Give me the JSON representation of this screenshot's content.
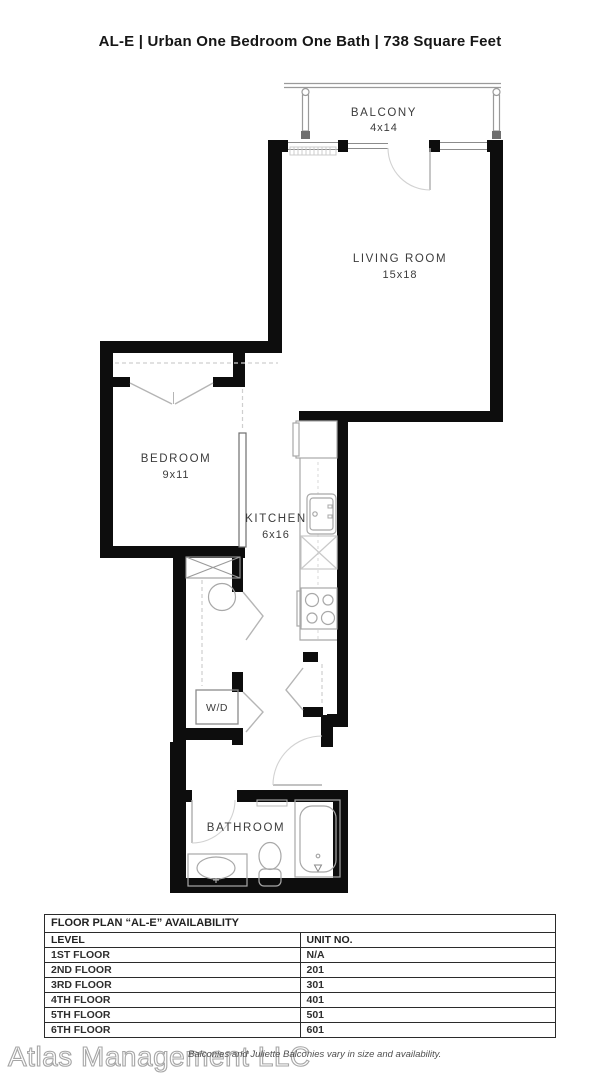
{
  "page_title": "AL-E | Urban One Bedroom One Bath | 738 Square Feet",
  "plan": {
    "balcony": {
      "name": "BALCONY",
      "dims": "4x14"
    },
    "living_room": {
      "name": "LIVING ROOM",
      "dims": "15x18"
    },
    "bedroom": {
      "name": "BEDROOM",
      "dims": "9x11"
    },
    "kitchen": {
      "name": "KITCHEN",
      "dims": "6x16"
    },
    "bathroom": {
      "name": "BATHROOM"
    },
    "laundry": {
      "name": "W/D"
    }
  },
  "availability_table": {
    "title": "FLOOR PLAN “AL-E” AVAILABILITY",
    "columns": [
      "LEVEL",
      "UNIT NO."
    ],
    "rows": [
      [
        "1ST FLOOR",
        "N/A"
      ],
      [
        "2ND FLOOR",
        "201"
      ],
      [
        "3RD FLOOR",
        "301"
      ],
      [
        "4TH FLOOR",
        "401"
      ],
      [
        "5TH FLOOR",
        "501"
      ],
      [
        "6TH FLOOR",
        "601"
      ]
    ]
  },
  "footer": {
    "watermark": "Atlas Management LLC",
    "disclaimer": "Balconies and Juliette Balconies vary in size and availability."
  },
  "colors": {
    "wall": "#0d0d0d",
    "fixture_line": "#a8a8a8",
    "door_line": "#c2c2c2",
    "label_text": "#3c3c3c",
    "watermark_outline": "#a6a6a6"
  }
}
